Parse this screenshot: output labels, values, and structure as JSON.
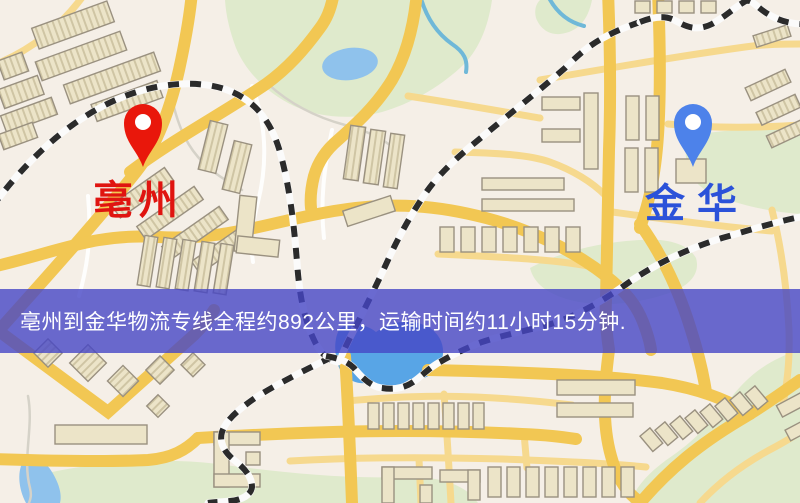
{
  "map": {
    "origin": {
      "name": "亳州",
      "pin_color": "#e9170b",
      "label_color": "#e01410"
    },
    "destination": {
      "name": "金华",
      "pin_color": "#4d82ea",
      "label_color": "#2b52d9"
    },
    "banner": {
      "text": "亳州到金华物流专线全程约892公里，运输时间约11小时15分钟.",
      "distance_km": "892",
      "duration": "11小时15分钟",
      "background": "rgba(70,70,197,0.8)",
      "text_color": "#ffffff"
    },
    "palette": {
      "background": "#f5efe7",
      "road_major": "#f2c753",
      "road_minor": "#f6d98e",
      "water": "#8fc2ec",
      "water_bright": "#58a5e6",
      "park": "#dfeacc",
      "railway_dash": "#2b2b2b",
      "building_fill": "#ece4c8",
      "building_stroke": "#9a9180"
    }
  }
}
